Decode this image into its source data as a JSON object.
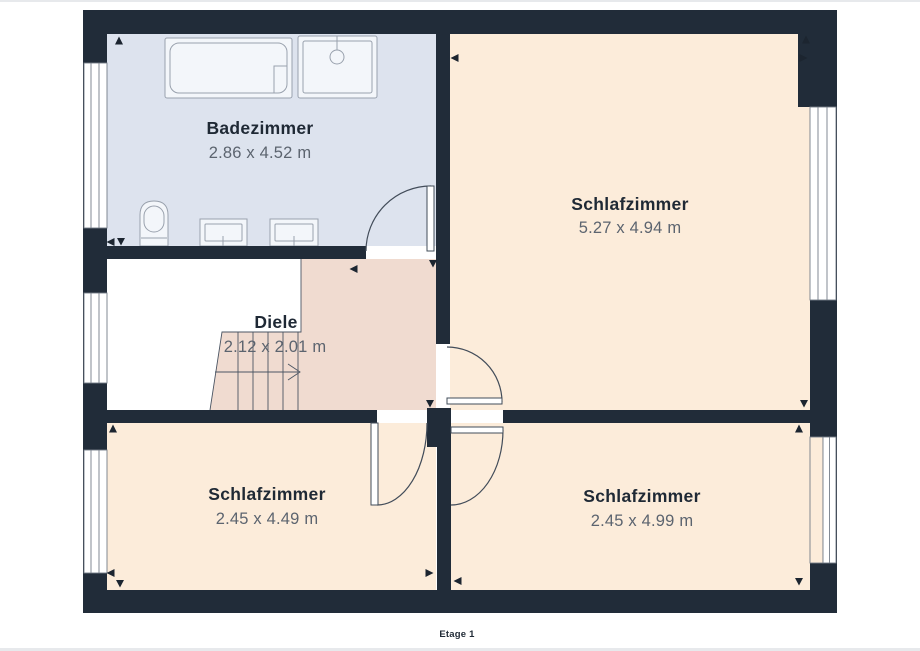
{
  "page": {
    "caption": "Etage 1"
  },
  "floorplan": {
    "rooms": [
      {
        "name": "Badezimmer",
        "dims": "2.86 x 4.52 m"
      },
      {
        "name": "Schlafzimmer",
        "dims": "5.27 x 4.94 m"
      },
      {
        "name": "Diele",
        "dims": "2.12 x 2.01 m"
      },
      {
        "name": "Schlafzimmer",
        "dims": "2.45 x 4.49 m"
      },
      {
        "name": "Schlafzimmer",
        "dims": "2.45 x 4.99 m"
      }
    ],
    "colors": {
      "wall": "#212c39",
      "bathroom_floor": "#dde3ee",
      "bedroom_floor": "#fcecda",
      "stairwell_floor": "#f0dbd0",
      "room_name_text": "#1f2935",
      "dimension_text": "#5c646f"
    }
  }
}
